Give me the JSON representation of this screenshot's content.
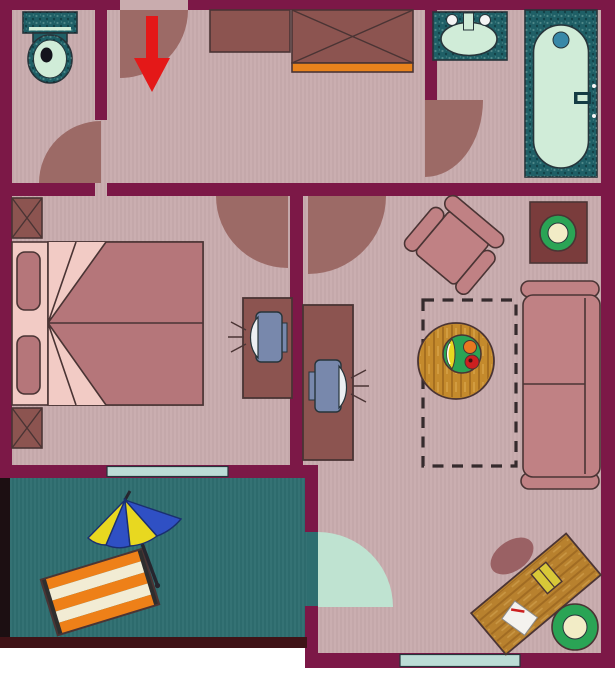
{
  "meta": {
    "kind": "apartment-floor-plan",
    "canvas": {
      "width": 615,
      "height": 700
    }
  },
  "palette": {
    "canvas_bg": "#ffffff",
    "wall": "#7c1847",
    "wall_balcony_left": "#1c0f12",
    "wall_balcony_bottom": "#401317",
    "floor": "#c9acae",
    "floor_balcony": "#2e6e70",
    "door_arc": "#9c6a66",
    "glass_arc": "#bfe3d1",
    "window": "#bcdcd6",
    "rose": "#c08184",
    "bed_blanket": "#b5767a",
    "bed_sheet": "#f2cbc5",
    "cabinet": "#8c5450",
    "orange": "#e8821c",
    "wood": "#c48a2c",
    "desk_wood": "#b8812e",
    "plant_table": "#7a3c3c",
    "green": "#2aa455",
    "cream": "#f2ecc6",
    "monitor": "#7888ac",
    "screen": "#eceff2",
    "fixture_teal": "#1f5f66",
    "fixture_mint": "#d0ecd8",
    "drain_blue": "#3888a8",
    "handle_dark": "#143c44",
    "chair_pad": "#9a6164",
    "lounger_orange": "#ee8018",
    "lounger_cream": "#f2ecd4",
    "lounger_end": "#2e2e2e",
    "umbrella_yellow": "#e8d820",
    "umbrella_blue": "#2f50c4",
    "umbrella_outline": "#1a2f70",
    "pole_dark": "#26262e",
    "arrow_red": "#e41818",
    "paper": "#f4f2ee",
    "book": "#d8c838",
    "apple_red": "#cc2020",
    "fruit_orange": "#e87820",
    "toilet_hole": "#14141c",
    "outline_furniture": "#4a3434",
    "outline_fixture": "#26343a",
    "dash_color": "#352b2d",
    "white_dot": "#f4f4f4"
  },
  "rooms": [
    {
      "id": "wc",
      "furniture": [
        "toilet"
      ]
    },
    {
      "id": "hallway",
      "furniture": [
        "cabinet",
        "wardrobe",
        "entrance-door",
        "entrance-arrow"
      ]
    },
    {
      "id": "bathroom",
      "furniture": [
        "sink",
        "bathtub"
      ]
    },
    {
      "id": "bedroom",
      "furniture": [
        "nightstand-top",
        "double-bed",
        "nightstand-bottom",
        "computer-desk-left",
        "computer-left"
      ]
    },
    {
      "id": "living-room",
      "furniture": [
        "armchair",
        "plant-table",
        "rug-outline",
        "coffee-table",
        "fruit-plate",
        "sofa",
        "computer-desk-right",
        "computer-right"
      ]
    },
    {
      "id": "study-corner",
      "furniture": [
        "seat-cushion",
        "writing-desk",
        "book",
        "paper-with-pen",
        "stool"
      ]
    },
    {
      "id": "balcony",
      "furniture": [
        "beach-umbrella",
        "lounger-mat"
      ]
    }
  ],
  "doors": [
    "entrance-top",
    "wc-door",
    "bedroom-door",
    "living-room-door",
    "bathroom-door",
    "balcony-glass-door"
  ],
  "windows": [
    "bedroom-balcony-window",
    "study-bottom-window"
  ]
}
